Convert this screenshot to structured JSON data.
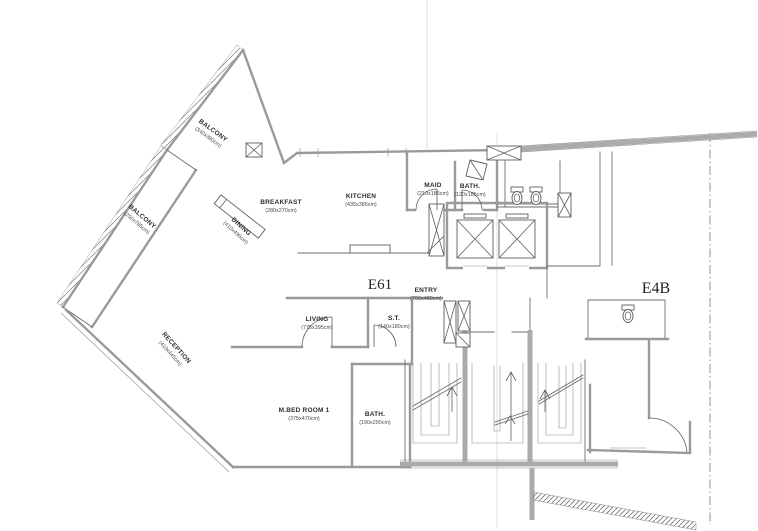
{
  "document_type": "apartment floor plan scan",
  "colors": {
    "paper": "#ffffff",
    "wall_gray": "#9a9a9a",
    "line_dark": "#5f5f5f",
    "text": "#2e2e2e"
  },
  "plan": {
    "unit_labels": {
      "left": "E61",
      "right": "E4B"
    },
    "rooms": {
      "balcony_top": {
        "name": "BALCONY",
        "dims": "(340x380cm)"
      },
      "balcony_left": {
        "name": "BALCONY",
        "dims": "(250x785cm)"
      },
      "breakfast": {
        "name": "BREAKFAST",
        "dims": "(280x270cm)"
      },
      "dining": {
        "name": "DINING",
        "dims": "(410x490cm)"
      },
      "kitchen": {
        "name": "KITCHEN",
        "dims": "(435x385cm)"
      },
      "maid": {
        "name": "MAID",
        "dims": "(210x185cm)"
      },
      "bath_top": {
        "name": "BATH.",
        "dims": "(120x185cm)"
      },
      "entry": {
        "name": "ENTRY",
        "dims": "(700x480cm)"
      },
      "living": {
        "name": "LIVING",
        "dims": "(775x395cm)"
      },
      "small_toilet": {
        "name": "S.T.",
        "dims": "(140x180cm)"
      },
      "reception": {
        "name": "RECEPTION",
        "dims": "(410x445cm)"
      },
      "master_bedroom": {
        "name": "M.BED ROOM 1",
        "dims": "(375x470cm)"
      },
      "bath_bottom": {
        "name": "BATH.",
        "dims": "(190x290cm)"
      }
    }
  }
}
